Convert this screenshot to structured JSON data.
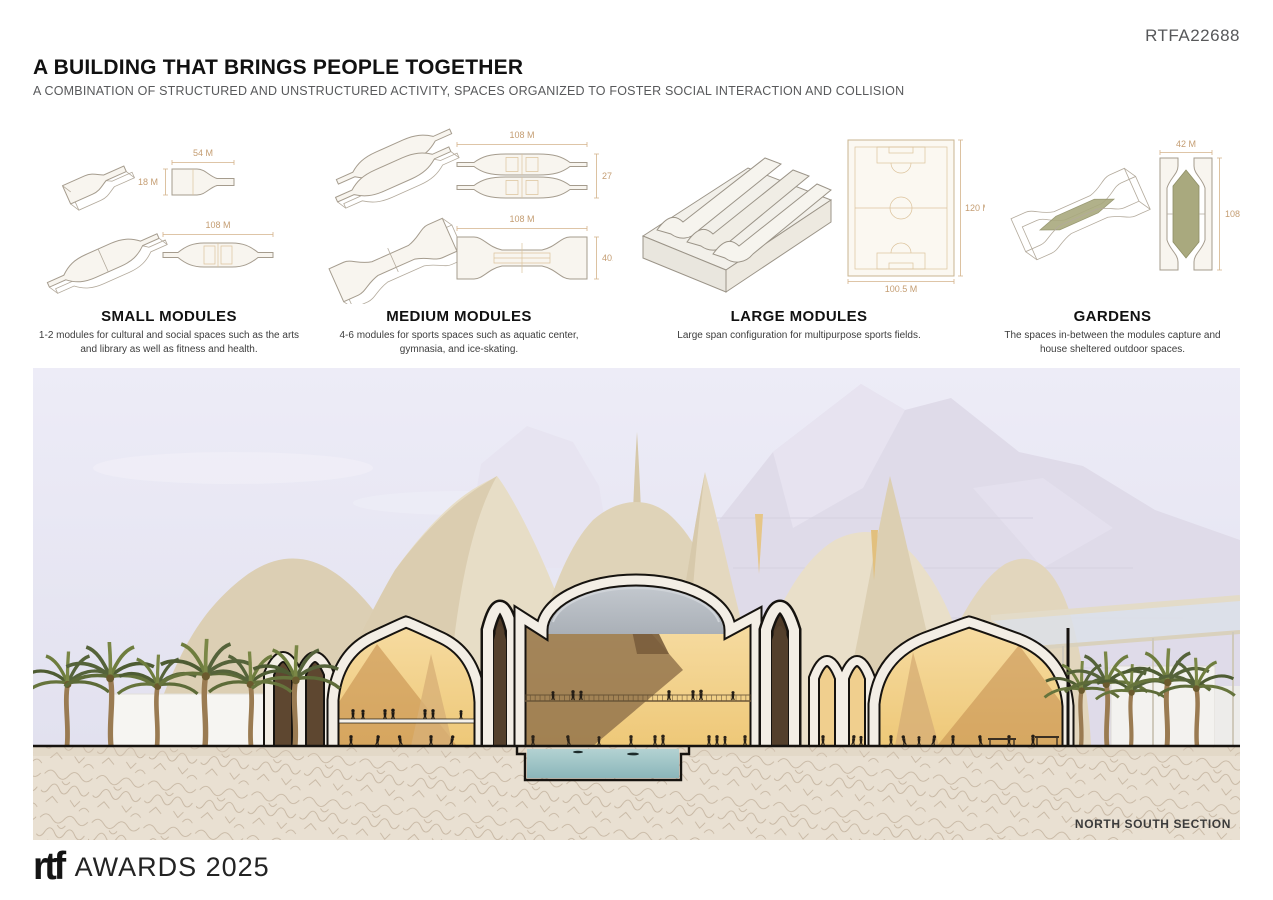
{
  "header": {
    "submission_id": "RTFA22688",
    "title": "A BUILDING THAT BRINGS PEOPLE TOGETHER",
    "subtitle": "A COMBINATION OF STRUCTURED AND UNSTRUCTURED ACTIVITY, SPACES ORGANIZED TO FOSTER SOCIAL INTERACTION AND COLLISION"
  },
  "modules": [
    {
      "name": "SMALL MODULES",
      "description": "1-2 modules for cultural and social spaces such as the arts and library as well as fitness and health.",
      "dims": {
        "d1": "54 M",
        "d2": "18 M",
        "d3": "108 M"
      }
    },
    {
      "name": "MEDIUM MODULES",
      "description": "4-6 modules for sports spaces such as aquatic center, gymnasia, and ice-skating.",
      "dims": {
        "d1": "108 M",
        "d2": "27 M",
        "d3": "108 M",
        "d4": "40.5 M"
      }
    },
    {
      "name": "LARGE MODULES",
      "description": "Large span configuration for multipurpose sports fields.",
      "dims": {
        "d1": "120 M",
        "d2": "100.5 M"
      }
    },
    {
      "name": "GARDENS",
      "description": "The spaces in-between the modules capture and house sheltered outdoor spaces.",
      "dims": {
        "d1": "42 M",
        "d2": "108 M"
      }
    }
  ],
  "render": {
    "caption": "NORTH SOUTH SECTION"
  },
  "footer": {
    "brand": "rtf",
    "awards_text": "AWARDS 2025"
  },
  "colors": {
    "sky": "#e9e8f4",
    "mountain": "#dfdbe9",
    "tent_light": "#eae0cb",
    "tent_mid": "#dccfb2",
    "tent_dark": "#cdbd9d",
    "interior_yellow": "#f3d492",
    "interior_shadow": "#8f6f49",
    "cut_band": "#f3eee5",
    "outline": "#16130f",
    "pool": "#9fc4c6",
    "ground": "#e9e0d2",
    "ground_squiggle": "#b5a28b",
    "palm_green": "#55633a",
    "palm_trunk": "#9a7b52",
    "garden_olive": "#a9a97e",
    "dim_label": "#c49d72",
    "id_gray": "#57585a"
  }
}
